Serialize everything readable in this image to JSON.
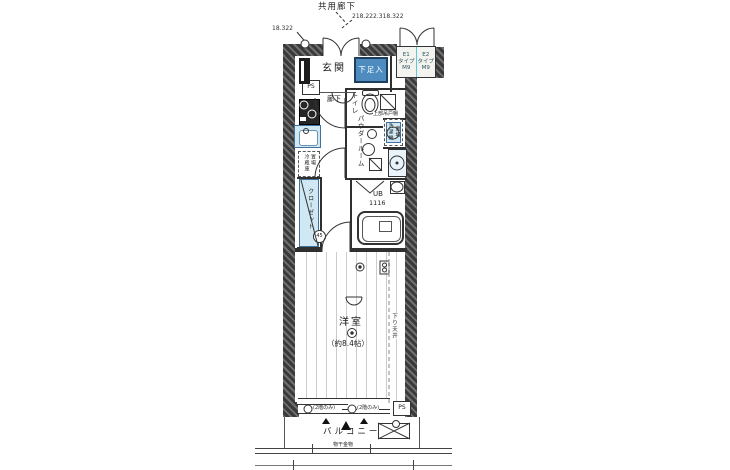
{
  "colors": {
    "wall_dark": "#3a3a3a",
    "fixture_fill": "#cfe8f4",
    "fixture_border": "#41719c",
    "shoe_box_fill": "#4e8cc0",
    "divider_cyan": "#5bc8de",
    "line": "#333333"
  },
  "labels": {
    "common_corridor": "共用廊下",
    "dim_units": "218.222.318.322",
    "dim_left": "18.322",
    "entrance": "玄関",
    "shoe_box": "下足入",
    "ps": "PS",
    "hallway": "廊下",
    "toilet": "トイレ",
    "upper_cabinet": "上部吊戸棚",
    "powder_room": "パウダールーム",
    "washer_l1": "洗濯機",
    "washer_l2": "置場",
    "fridge_l1": "冷蔵庫",
    "fridge_l2": "置場",
    "closet": "クローゼット",
    "mark_45": "45",
    "ub": "UB",
    "ub_size": "1116",
    "room": "洋室",
    "room_area": "（約8.4帖）",
    "lowered_ceiling": "下り天井",
    "window_note": "(2階のみ)",
    "balcony": "バルコニー",
    "laundry_fitting": "物干金物",
    "e1_l1": "E1",
    "e1_l2": "タイプ",
    "e1_l3": "M9",
    "e2_l1": "E2",
    "e2_l2": "タイプ",
    "e2_l3": "M9"
  }
}
